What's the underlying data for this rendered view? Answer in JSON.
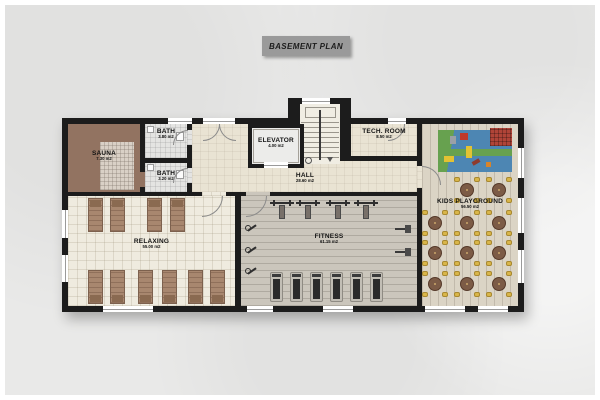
{
  "title": "BASEMENT PLAN",
  "rooms": {
    "sauna": {
      "label": "SAUNA",
      "area": "7.30 m2"
    },
    "bath_top": {
      "label": "BATH",
      "area": "3.80 m2"
    },
    "bath_bottom": {
      "label": "BATH",
      "area": "3.20 m2"
    },
    "elevator": {
      "label": "ELEVATOR",
      "area": "4.00 m2"
    },
    "tech_room": {
      "label": "TECH. ROOM",
      "area": "8.50 m2"
    },
    "hall": {
      "label": "HALL",
      "area": "28.60 m2"
    },
    "relaxing": {
      "label": "RELAXING",
      "area": "55.00 m2"
    },
    "fitness": {
      "label": "FITNESS",
      "area": "61.15 m2"
    },
    "kids": {
      "label": "KIDS PLAYGROUND",
      "area": "56.50 m2"
    }
  },
  "colors": {
    "background": "#e9e9e8",
    "wall": "#1c1c1c",
    "title_box": "#9a9a9a",
    "hall_floor": "#e9e3d3",
    "relaxing_floor": "#efebdf",
    "fitness_floor": "#cbc6bc",
    "kids_floor": "#dbd4c5",
    "bath_floor": "#e4e4e2",
    "sauna_floor": "#927361",
    "play_mat_blue": "#4d86b3",
    "play_mat_green": "#67a14f",
    "table_brown": "#7c5b46",
    "chair_yellow": "#d9b64a",
    "lounger_brown": "#a8876f"
  }
}
